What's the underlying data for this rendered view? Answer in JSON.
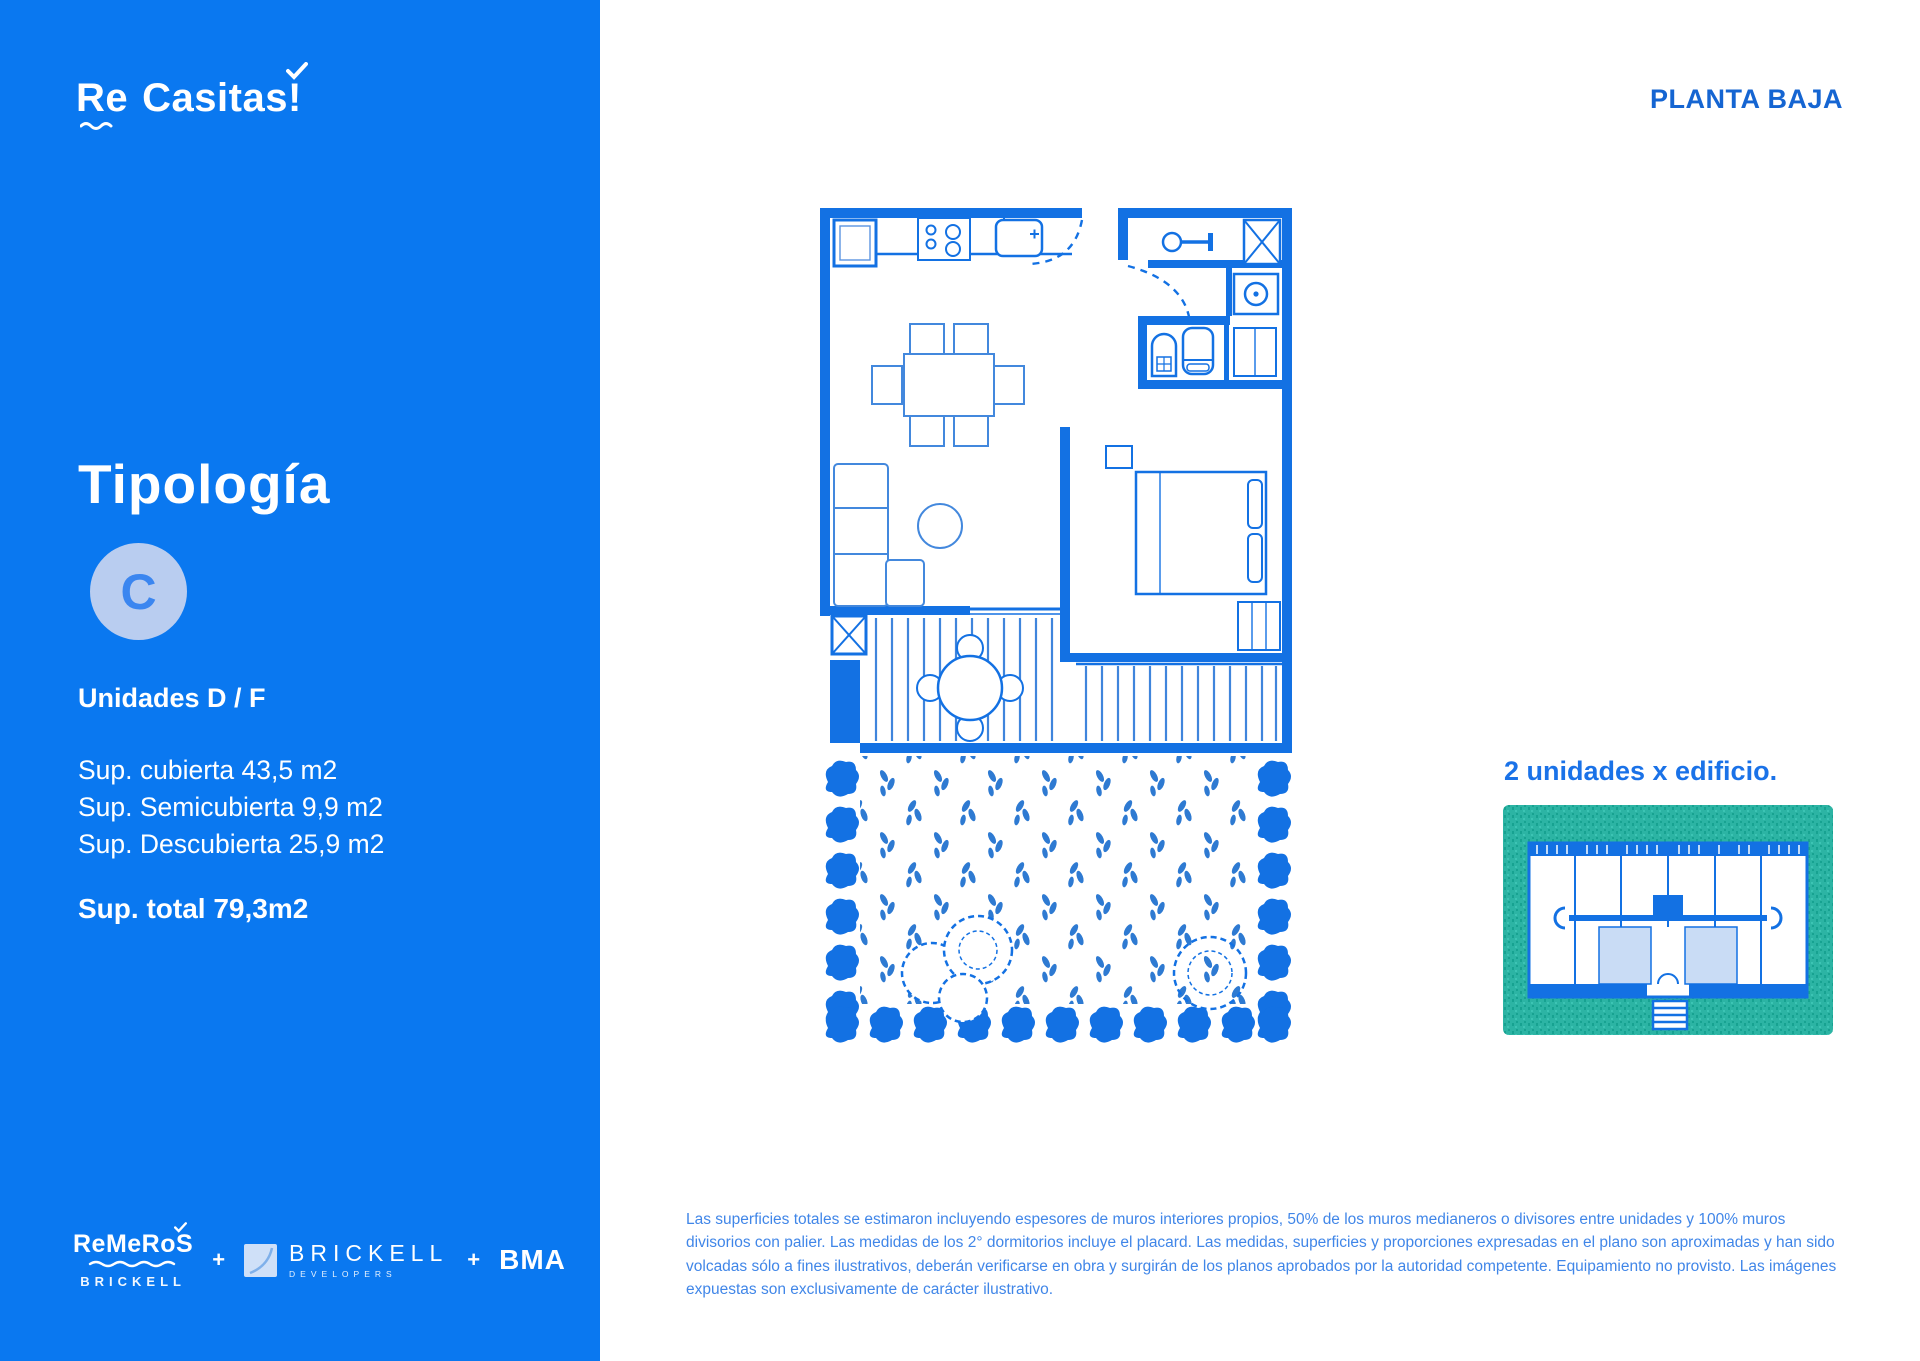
{
  "colors": {
    "sidebar_blue": "#0a78f0",
    "plan_blue": "#1371e3",
    "furniture_blue": "#4388dd",
    "keyplan_teal": "#2cb4a4",
    "unit_highlight": "#c9dcf5",
    "title_blue": "#1565d2",
    "caption_blue": "#1a72e8",
    "disclaimer_blue": "#4086e8",
    "badge_bg": "#b9cdf0"
  },
  "sidebar": {
    "logo": {
      "part1": "Re",
      "part2": "Casitas!"
    },
    "title": "Tipología",
    "type_letter": "C",
    "units": "Unidades D / F",
    "areas": [
      "Sup. cubierta 43,5 m2",
      "Sup. Semicubierta 9,9 m2",
      "Sup. Descubierta 25,9 m2"
    ],
    "total": "Sup. total 79,3m2",
    "partners": {
      "remeros": "ReMeRoS",
      "remeros_sub": "BRICKELL",
      "plus_a": "+",
      "brickell": "BRICKELL",
      "brickell_sub": "DEVELOPERS",
      "plus_b": "+",
      "bma": "BMA"
    }
  },
  "main": {
    "page_title": "PLANTA BAJA",
    "keyplan_caption": "2 unidades x edificio.",
    "disclaimer": "Las superficies totales se estimaron incluyendo espesores de muros interiores propios, 50% de los muros medianeros o divisores entre unidades y 100% muros divisorios con palier. Las medidas de los 2° dormitorios incluye el placard. Las medidas, superficies y proporciones expresadas en el plano son aproximadas y han sido volcadas sólo a fines ilustrativos, deberán verificarse en obra y surgirán de los planos aprobados por la autoridad competente. Equipamiento no provisto. Las imágenes expuestas son exclusivamente de carácter ilustrativo."
  }
}
